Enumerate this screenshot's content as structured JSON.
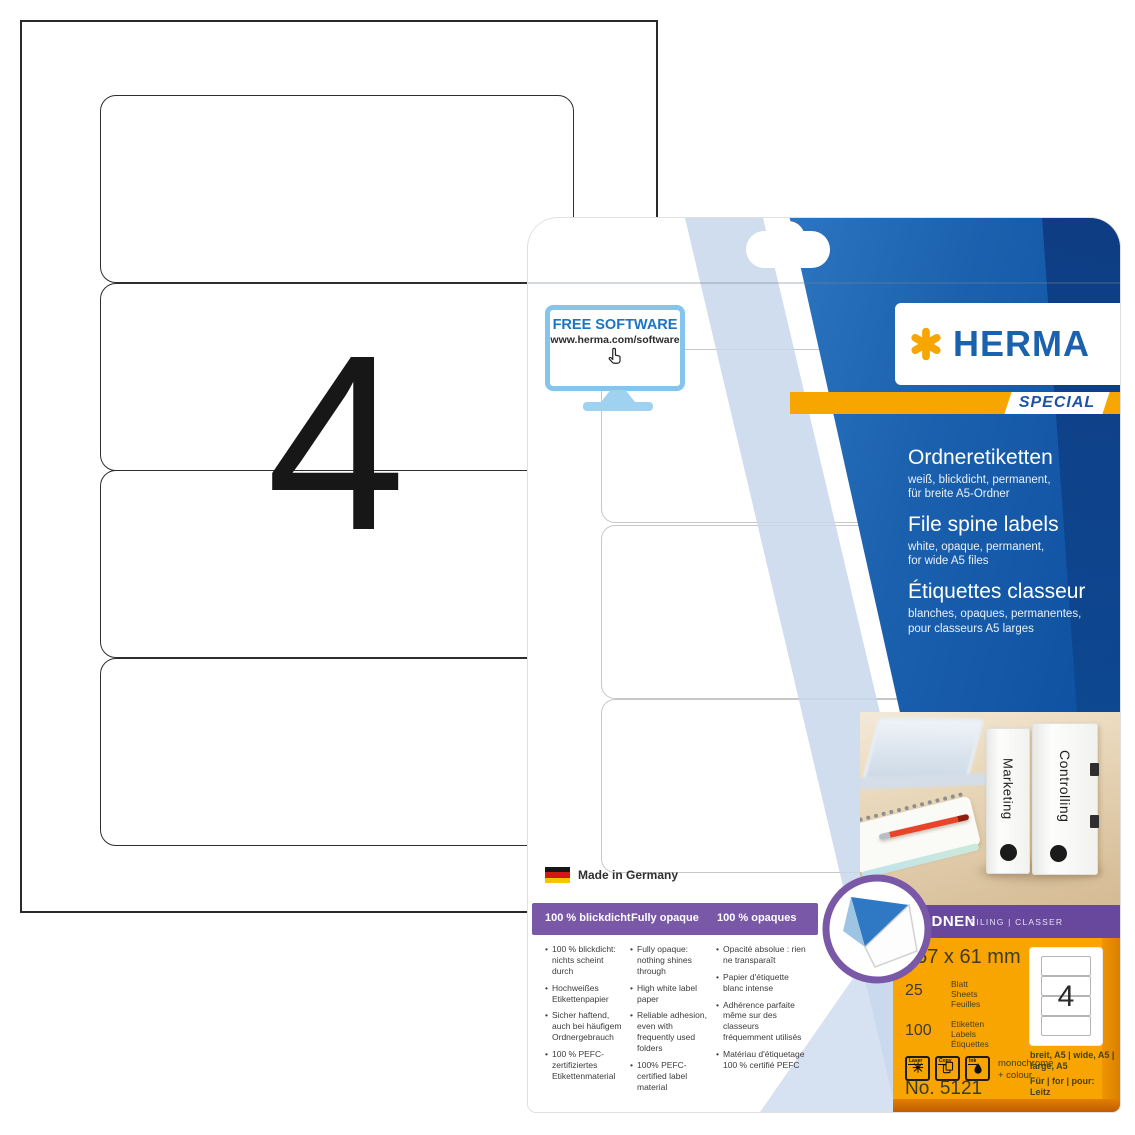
{
  "sheet": {
    "count": "4"
  },
  "package": {
    "free_software": {
      "title": "FREE SOFTWARE",
      "url": "www.herma.com/software"
    },
    "brand": {
      "name": "HERMA",
      "edition": "SPECIAL"
    },
    "titles": [
      {
        "title": "Ordneretiketten",
        "lines": [
          "weiß, blickdicht, permanent,",
          "für breite A5-Ordner"
        ]
      },
      {
        "title": "File spine labels",
        "lines": [
          "white, opaque, permanent,",
          "for wide A5 files"
        ]
      },
      {
        "title": "Étiquettes classeur",
        "lines": [
          "blanches, opaques, permanentes,",
          "pour classeurs A5 larges"
        ]
      }
    ],
    "made_in": "Made in Germany",
    "claims": [
      "100 % blickdicht",
      "Fully opaque",
      "100 % opaques"
    ],
    "bullets": {
      "de": [
        "100 % blickdicht: nichts scheint durch",
        "Hochweißes Etikettenpapier",
        "Sicher haftend, auch bei häufigem Ordnergebrauch",
        "100 % PEFC-zertifiziertes Etikettenmaterial"
      ],
      "en": [
        "Fully opaque: nothing shines through",
        "High white label paper",
        "Reliable adhesion, even with frequently used folders",
        "100% PEFC-certified label material"
      ],
      "fr": [
        "Opacité absolue : rien ne transparaît",
        "Papier d'étiquette blanc intense",
        "Adhérence parfaite même sur des classeurs fréquemment utilisés",
        "Matériau d'étiquetage 100 % certifié PEFC"
      ]
    },
    "category": {
      "title": "ORDNEN",
      "subtitle": "FILING | CLASSER"
    },
    "photo": {
      "binders": [
        "Marketing",
        "Controlling"
      ]
    },
    "specs": {
      "size": "157 x 61 mm",
      "sheet_count": "25",
      "sheet_words": [
        "Blatt",
        "Sheets",
        "Feuilles"
      ],
      "label_count": "100",
      "label_words": [
        "Etiketten",
        "Labels",
        "Étiquettes"
      ],
      "printer_icons": [
        "Laser",
        "Copy",
        "Ink"
      ],
      "printer_note_lines": [
        "monochrome",
        "+ colour"
      ],
      "per_sheet": "4",
      "format_lines": [
        "breit, A5 | wide, A5 |",
        "large, A5"
      ],
      "for_lines": [
        "Für | for | pour:",
        "Leitz"
      ],
      "article_no": "No. 5121"
    },
    "colors": {
      "herma_blue": "#1a61ae",
      "herma_orange": "#f7a600",
      "purple": "#7a58a8",
      "purple_dark": "#67489c",
      "panel_orange": "#f9a501",
      "navy": "#0d478f"
    }
  }
}
